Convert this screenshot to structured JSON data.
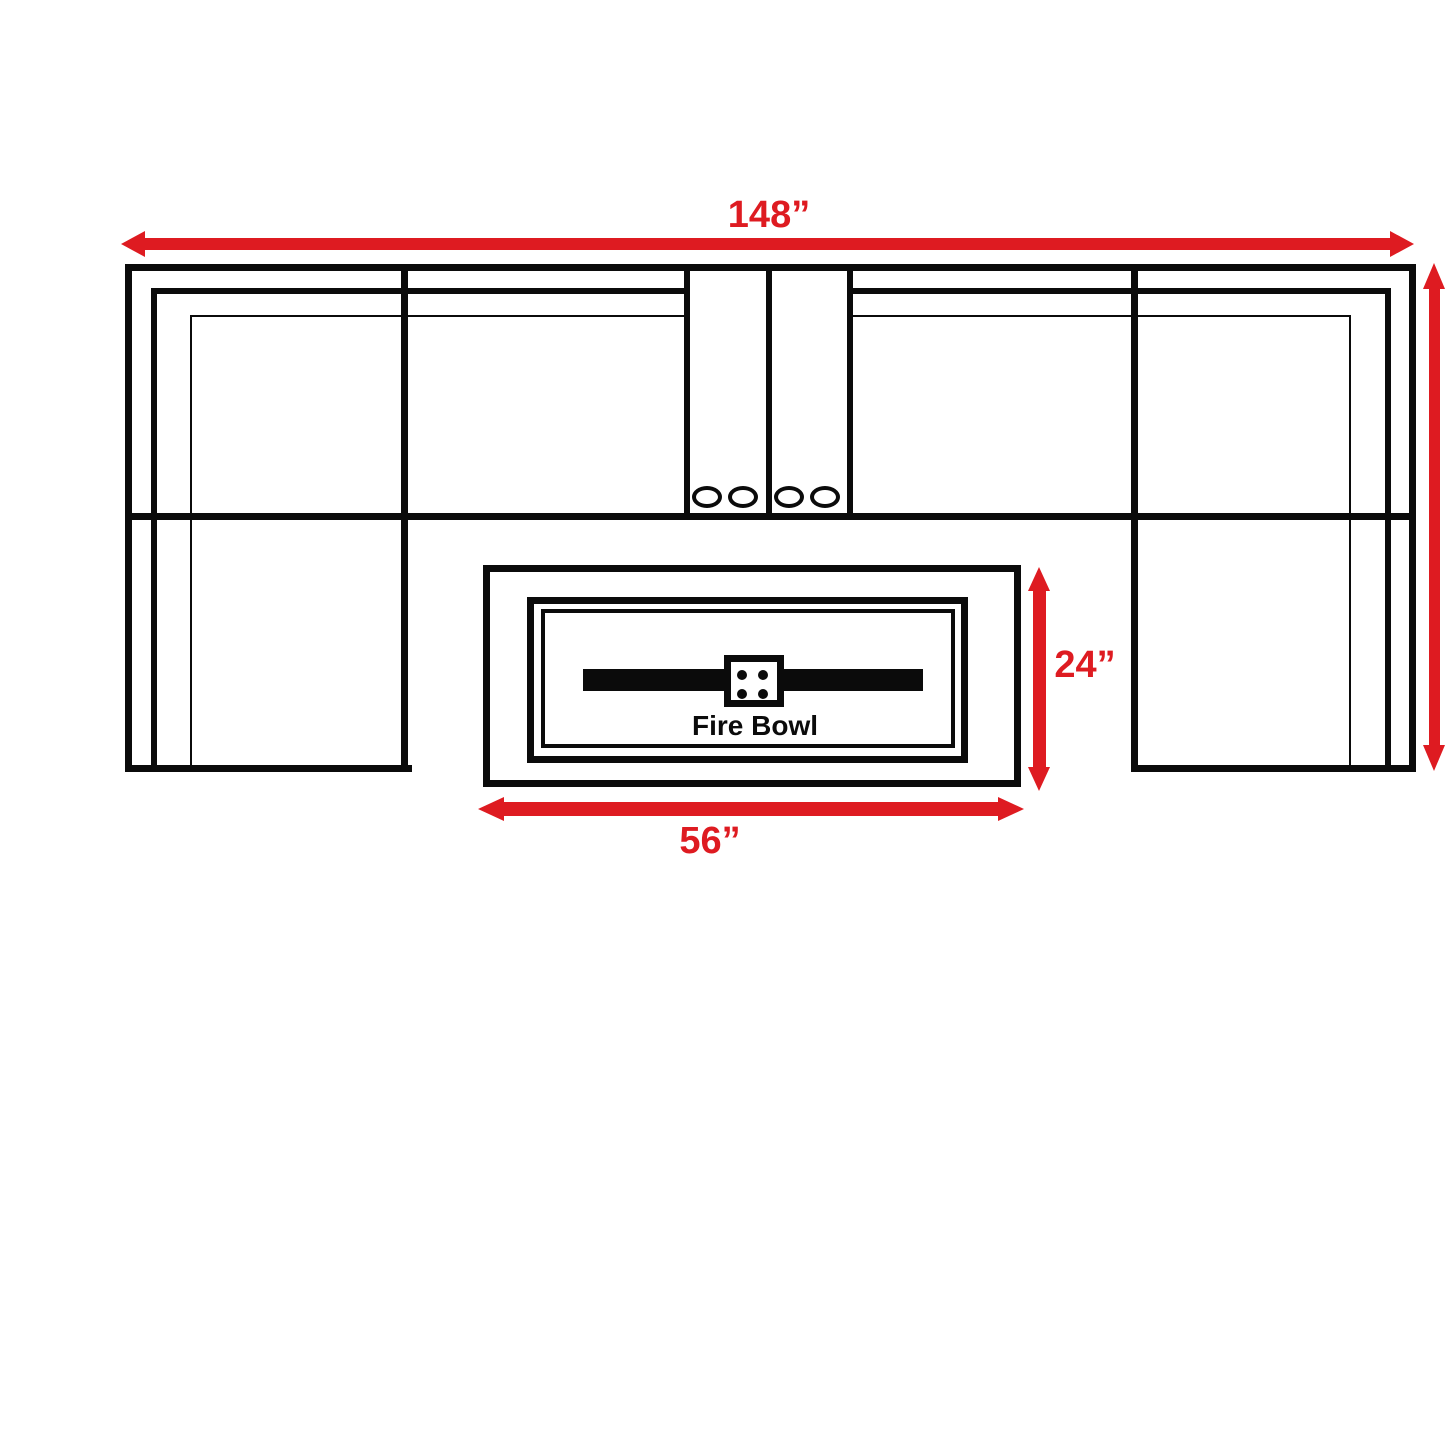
{
  "page": {
    "background": "#ffffff"
  },
  "colors": {
    "dimension_red": "#de1b21",
    "line_black": "#0b0b0b",
    "fill_white": "#ffffff"
  },
  "dimensions": {
    "overall_width": "148”",
    "firebowl_width": "56”",
    "firebowl_height": "24”"
  },
  "firebowl": {
    "label": "Fire Bowl"
  },
  "icons": {
    "dimension_arrow": "red double-headed arrow",
    "cup_holder": "small ellipse outline",
    "burner": "black horizontal bar",
    "igniter": "white square with 4 dots"
  }
}
